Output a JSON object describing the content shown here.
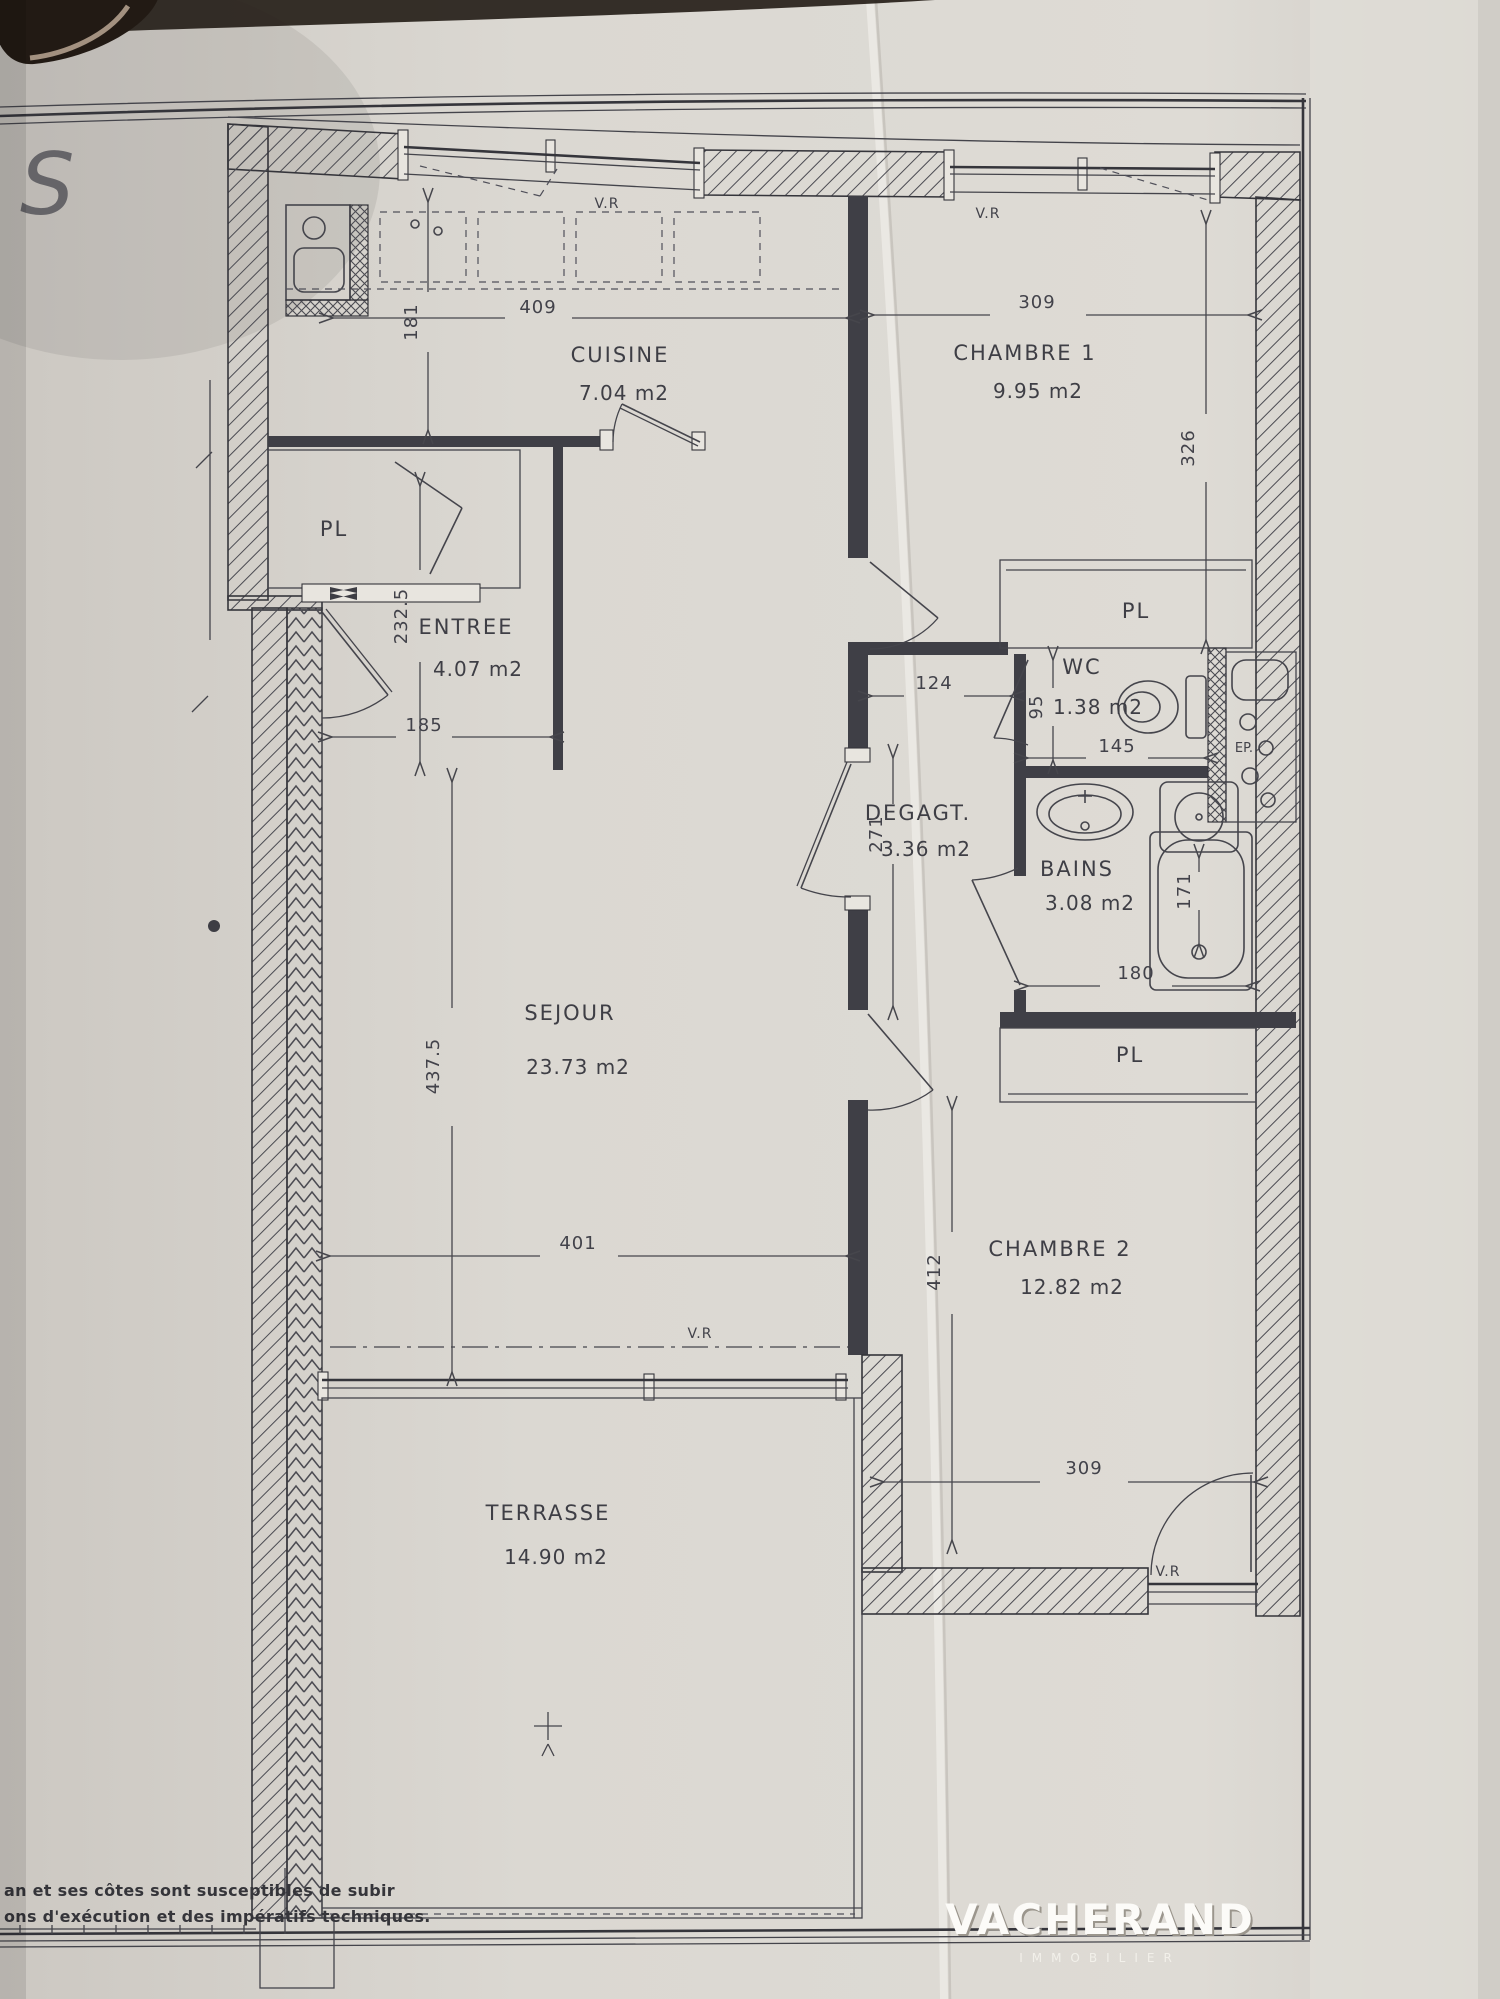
{
  "plan": {
    "rooms": {
      "cuisine": {
        "label": "CUISINE",
        "area": "7.04  m2"
      },
      "chambre1": {
        "label": "CHAMBRE  1",
        "area": "9.95  m2"
      },
      "entree": {
        "label": "ENTREE",
        "area": "4.07  m2"
      },
      "wc": {
        "label": "WC",
        "area": "1.38  m2"
      },
      "degagement": {
        "label": "DEGAGT.",
        "area": "3.36  m2"
      },
      "bains": {
        "label": "BAINS",
        "area": "3.08  m2"
      },
      "sejour": {
        "label": "SEJOUR",
        "area": "23.73  m2"
      },
      "chambre2": {
        "label": "CHAMBRE  2",
        "area": "12.82  m2"
      },
      "terrasse": {
        "label": "TERRASSE",
        "area": "14.90  m2"
      }
    },
    "closets": {
      "entree": "PL",
      "chambre1": "PL",
      "bains": "PL"
    },
    "shaft": {
      "label": "EP."
    },
    "windows": {
      "cuisine": "V.R",
      "chambre1": "V.R",
      "sejour": "V.R",
      "chambre2": "V.R"
    },
    "dims": {
      "cuisine_width": "409",
      "cuisine_depth": "181",
      "chambre1_width": "309",
      "chambre1_depth": "326",
      "entree_depth": "232.5",
      "entree_width": "185",
      "degagt_width": "124",
      "degagt_length": "271",
      "wc_depth": "95",
      "wc_width": "145",
      "tub_length": "171",
      "bains_width": "180",
      "sejour_depth": "437.5",
      "sejour_width": "401",
      "chambre2_depth": "412",
      "chambre2_width": "309"
    }
  },
  "annotations": {
    "watermark": "S",
    "disclaimer_line1": "an et ses côtes sont susceptibles de subir",
    "disclaimer_line2": "ons d'exécution et des impératifs techniques."
  },
  "logo": {
    "brand": "VACHERAND",
    "tagline": "IMMOBILIER"
  },
  "colors": {
    "paper": "#d8d5cf",
    "ink": "#3e3e45",
    "logo": "#fcfbf8"
  }
}
